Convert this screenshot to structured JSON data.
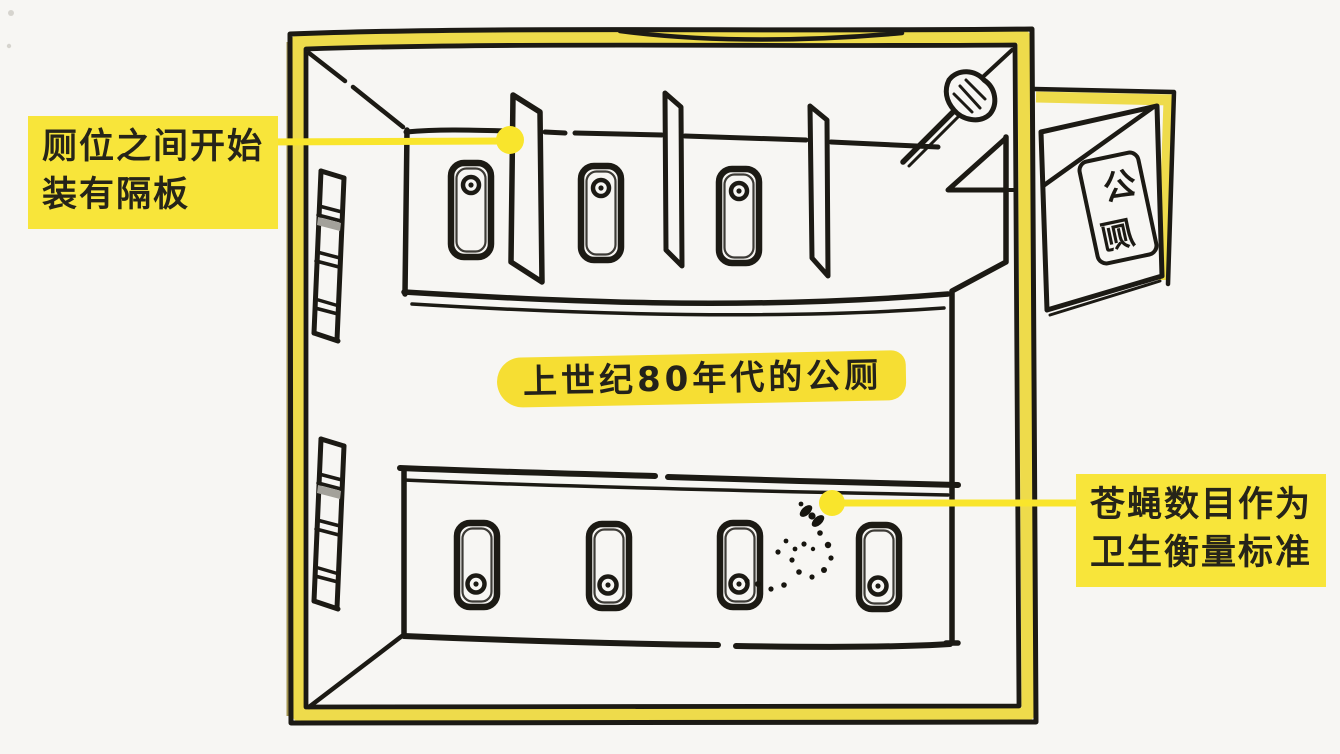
{
  "scene": {
    "title": "上世纪80年代的公厕",
    "callout_left": {
      "line1": "厕位之间开始",
      "line2": "装有隔板"
    },
    "callout_right": {
      "line1": "苍蝇数目作为",
      "line2": "卫生衡量标准"
    },
    "door_sign": "公厕",
    "colors": {
      "highlight_yellow": "#f8e53a",
      "marker_yellow": "#f6de33",
      "wall_band_yellow": "#eedb4b",
      "leader_yellow": "#f9e52c",
      "ink": "#1c1a14",
      "paper": "#f7f6f3"
    },
    "drawing": {
      "top_row_toilets": 3,
      "top_row_partitions": 3,
      "bottom_row_toilets": 4,
      "louver_vents": 2,
      "flies": 1
    }
  }
}
